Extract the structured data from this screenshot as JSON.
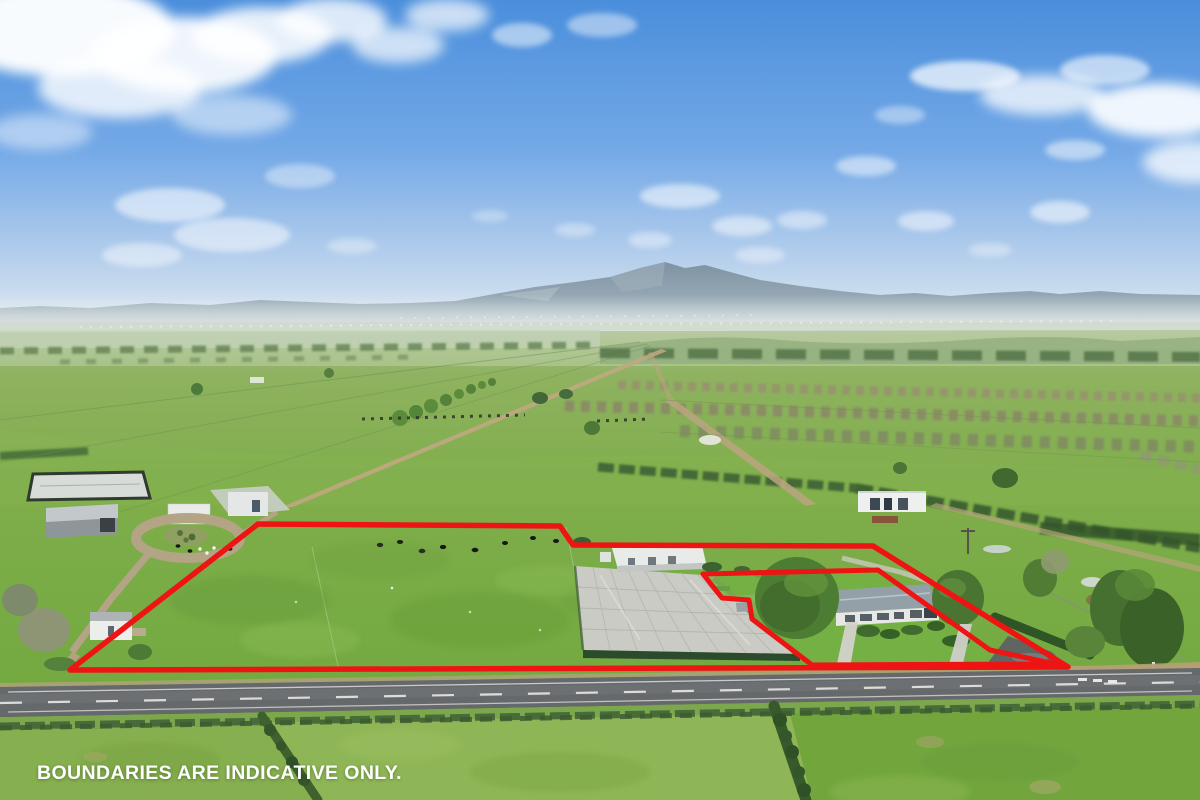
{
  "overlay": {
    "disclaimer": "BOUNDARIES ARE INDICATIVE ONLY.",
    "boundary_color": "#ee1414"
  },
  "scene": {
    "description": "Aerial drone photograph of flat rural farmland: red indicative boundary lines outline a large grass paddock, a shade-house and a farmhouse lot beside a two-lane country road, with paddocks, tree rows, grazing cattle and a hazy mountain range on the horizon under a blue sky with scattered clouds",
    "colors": {
      "sky_top": "#4a8edc",
      "sky_horizon": "#e4ecf1",
      "cloud_white": "#ffffff",
      "mountain_haze": "#8a9cab",
      "grass_bright": "#7ab04a",
      "grass_dark": "#476c36",
      "shade_house_gray": "#cacbc4",
      "road_asphalt": "#66696b",
      "track_tan": "#bba580",
      "house_roof_gray": "#93a0a8",
      "text_white": "#ffffff"
    }
  }
}
